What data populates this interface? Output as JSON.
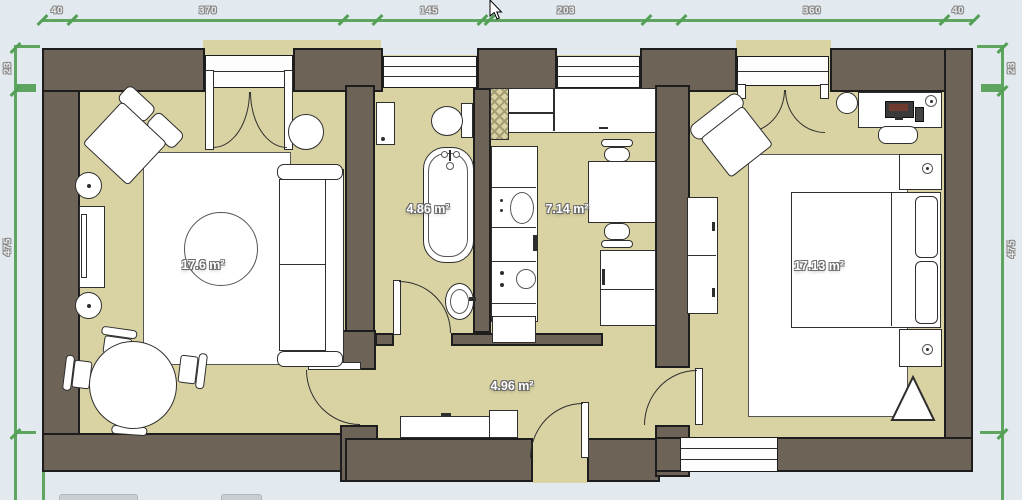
{
  "dims": {
    "top": {
      "a": "40",
      "b": "370",
      "c": "145",
      "d": "203",
      "e": "360",
      "f": "40"
    },
    "left": {
      "wall": "23",
      "height": "475"
    },
    "right": {
      "wall": "23",
      "height": "475"
    }
  },
  "rooms": {
    "living": {
      "area": "17.6 m²"
    },
    "bathroom": {
      "area": "4.86 m²"
    },
    "kitchen": {
      "area": "7.14 m²"
    },
    "bedroom": {
      "area": "17.13 m²"
    },
    "hallway": {
      "area": "4.96 m²"
    }
  },
  "colors": {
    "background": "#e2eaef",
    "wall": "#6d6357",
    "floor": "#d9d2a2",
    "dimension_line": "#5ea55f",
    "furniture_outline": "#2e2e2e"
  }
}
